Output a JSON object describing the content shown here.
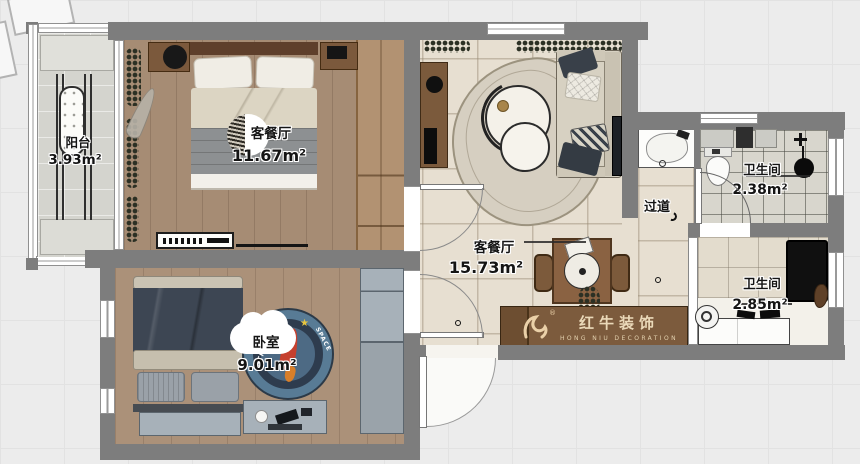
{
  "rooms": {
    "balcony": {
      "name": "阳台",
      "area": "3.93m²"
    },
    "master_bedroom": {
      "name": "客餐厅",
      "area": "11.67m²"
    },
    "living_dining": {
      "name": "客餐厅",
      "area": "15.73m²"
    },
    "hallway": {
      "name": "过道"
    },
    "bathroom_top": {
      "name": "卫生间",
      "area": "2.38m²"
    },
    "bathroom_bottom": {
      "name": "卫生间",
      "area": "2.85m²"
    },
    "kids_bedroom": {
      "name": "卧室",
      "area": "9.01m²"
    }
  },
  "watermark": {
    "brand": "红牛装饰",
    "subtitle": "HONG NIU DECORATION",
    "registered": "®"
  },
  "rug": {
    "arc_text_right": "SPACE",
    "arc_text_left": "PATROL",
    "star": "★"
  },
  "colors": {
    "wall": "#7d7d7d",
    "wood_floor": "#a68c74",
    "tile_floor": "#e7dfd1",
    "cabinet_brown": "#7c5b3d",
    "logo_cream": "#ead9b9",
    "rug_blue": "#587b95"
  }
}
